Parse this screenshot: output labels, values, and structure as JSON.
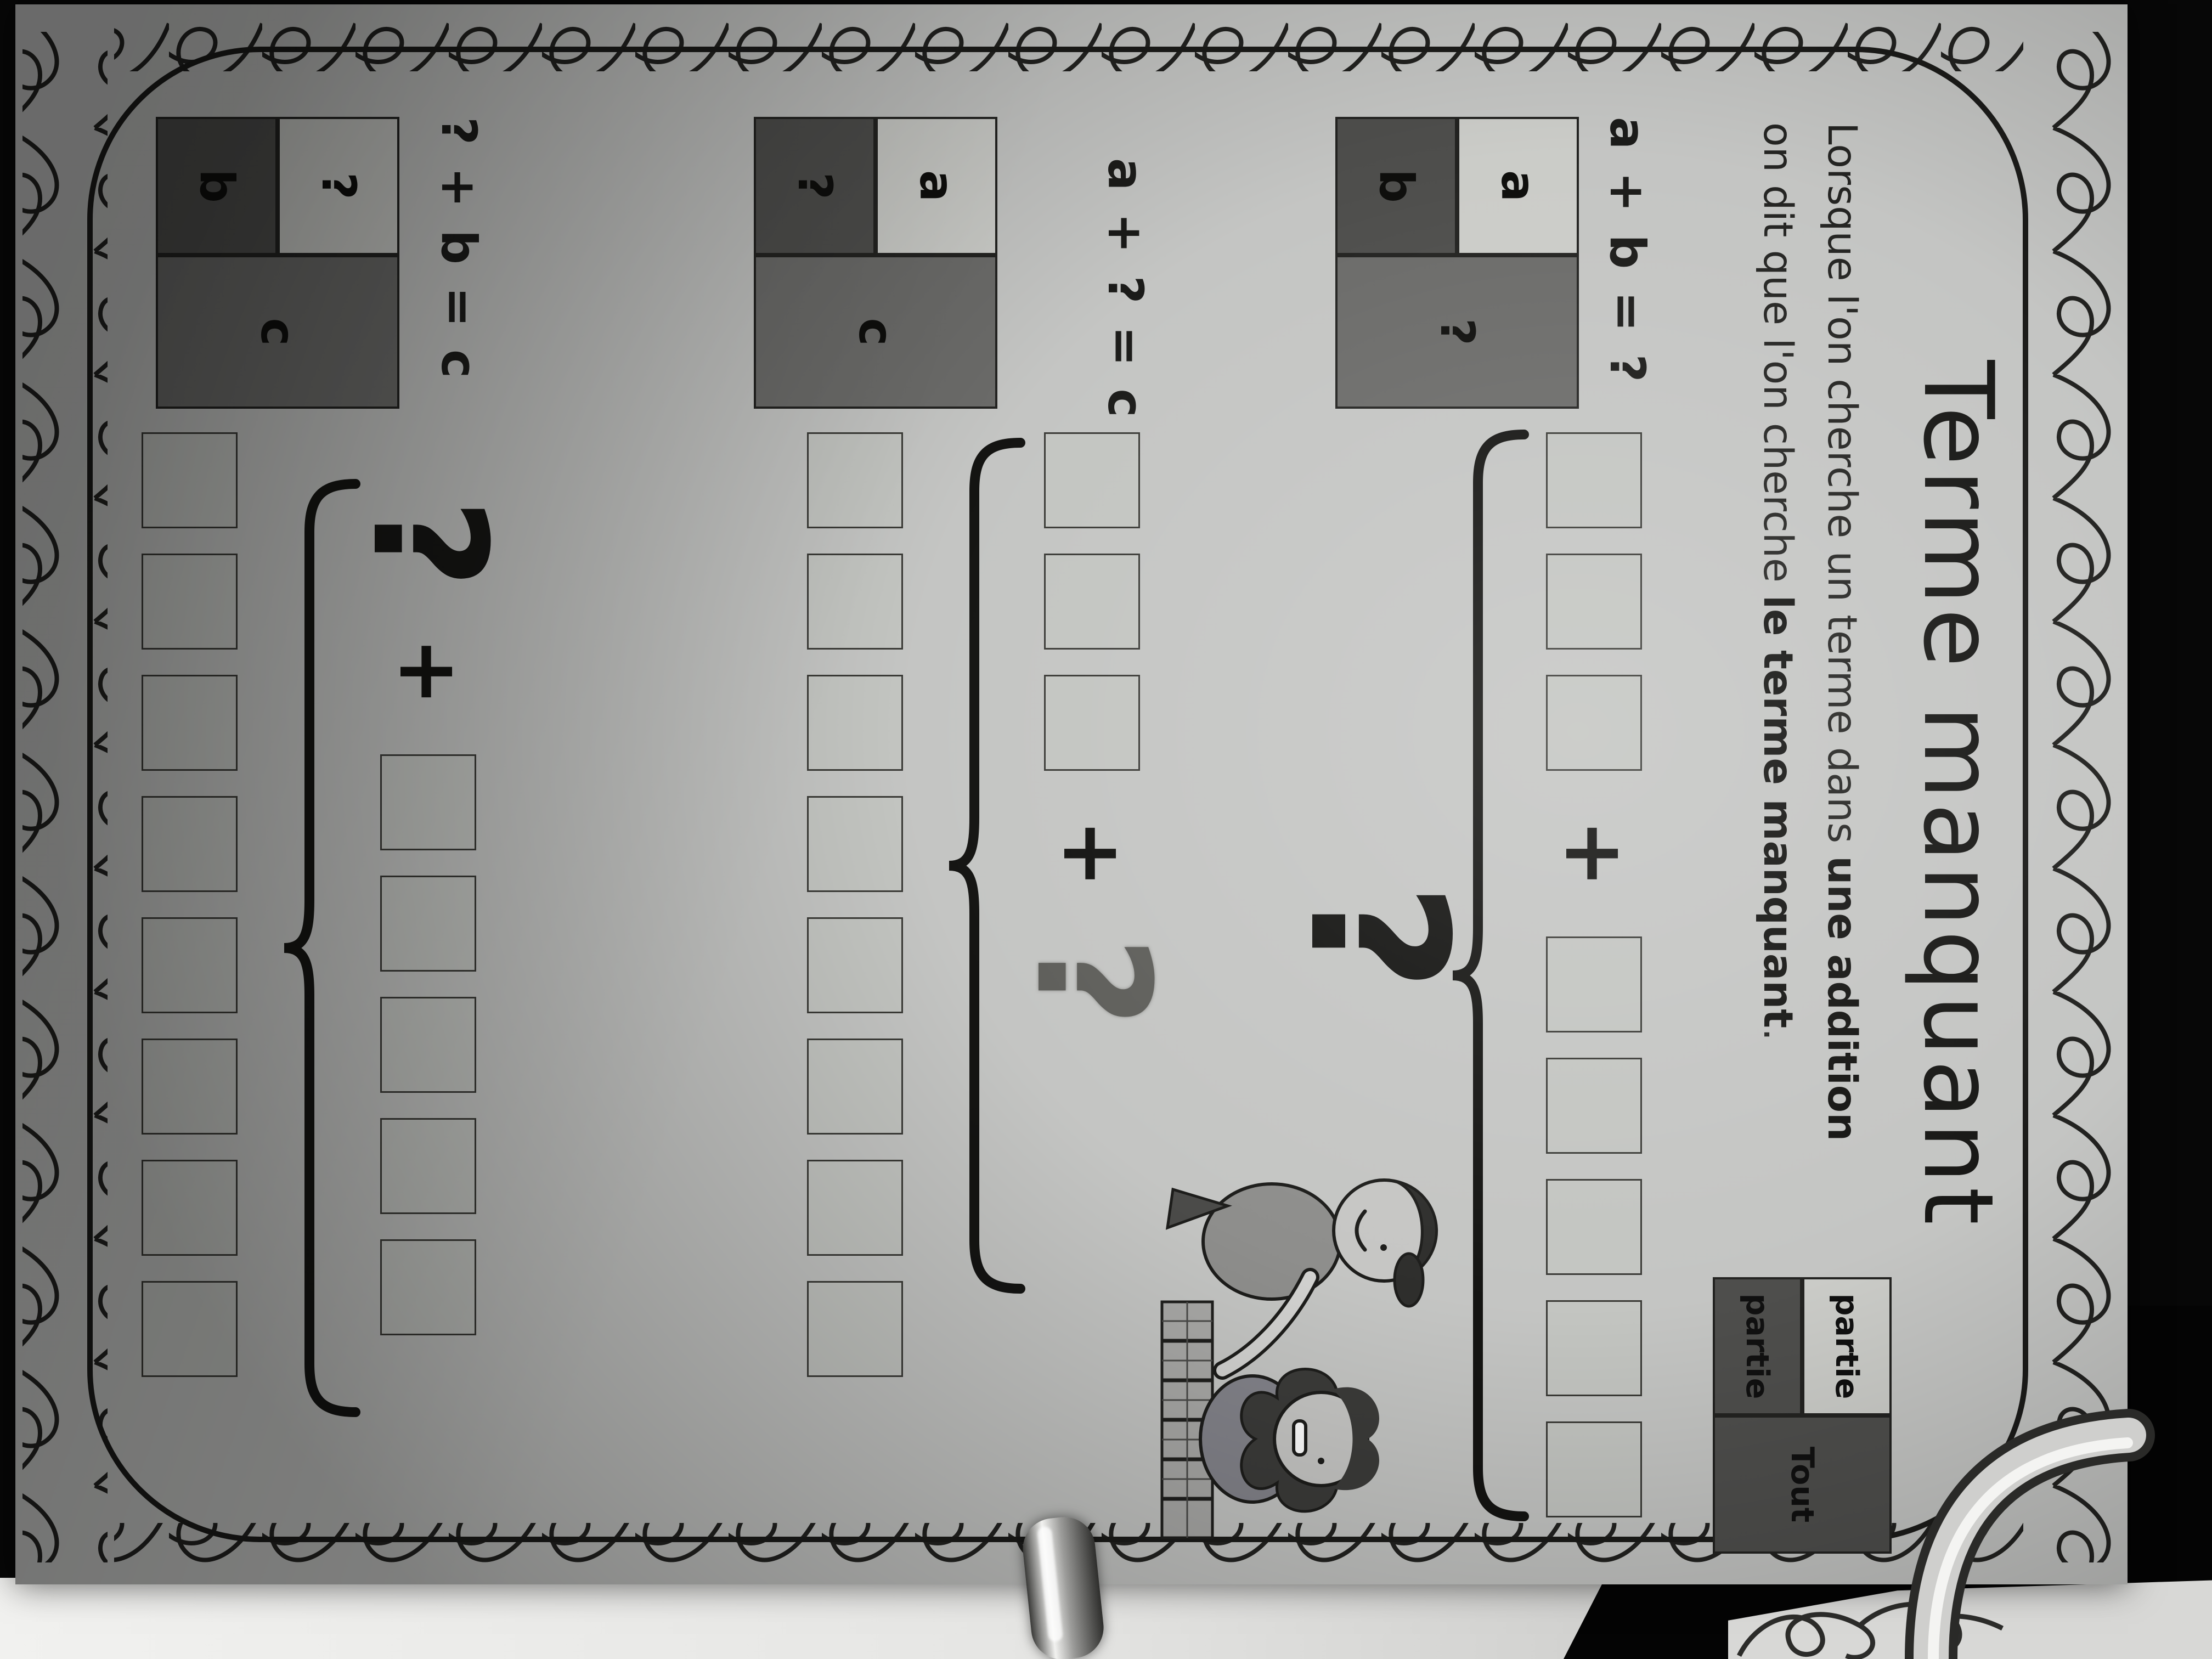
{
  "page": {
    "title": "Terme manquant",
    "intro": {
      "line1_text": "Lorsque l'on cherche un terme dans ",
      "line1_bold": "une addition",
      "line2_text": "on dit que l'on cherche ",
      "line2_bold": "le terme manquant",
      "line2_suffix": "."
    },
    "part_whole_table": {
      "part_top": "partie",
      "part_bottom": "partie",
      "whole": "Tout"
    },
    "problems": [
      {
        "equation": "a + b = ?",
        "model": {
          "part_top": {
            "label": "a",
            "shade": "light"
          },
          "part_bottom": {
            "label": "b",
            "shade": "dark"
          },
          "whole": {
            "label": "?",
            "shade": "medium"
          }
        },
        "pictorial": {
          "addend1_squares": 3,
          "operator": "+",
          "addend2_squares": 5,
          "sum_symbol": "?"
        }
      },
      {
        "equation": "a + ? = c",
        "model": {
          "part_top": {
            "label": "a",
            "shade": "light"
          },
          "part_bottom": {
            "label": "?",
            "shade": "dark"
          },
          "whole": {
            "label": "c",
            "shade": "medium"
          }
        },
        "pictorial": {
          "addend1_squares": 3,
          "operator": "+",
          "addend2_symbol": "?",
          "sum_squares": 8
        }
      },
      {
        "equation": "? + b = c",
        "model": {
          "part_top": {
            "label": "?",
            "shade": "light"
          },
          "part_bottom": {
            "label": "b",
            "shade": "dark"
          },
          "whole": {
            "label": "c",
            "shade": "medium"
          }
        },
        "pictorial": {
          "addend1_symbol": "?",
          "operator": "+",
          "addend2_squares": 5,
          "sum_squares": 8
        }
      }
    ],
    "illustration": {
      "description": "two children playing with a row of grey building blocks"
    }
  },
  "colors": {
    "paper": "#c4c5c3",
    "ink": "#1a1a18",
    "square_fill": "#c3c5c1",
    "cell_light": "#cbccc8",
    "cell_dark": "#4e4e4c",
    "cell_medium": "#6b6b69",
    "background": "#070707"
  }
}
